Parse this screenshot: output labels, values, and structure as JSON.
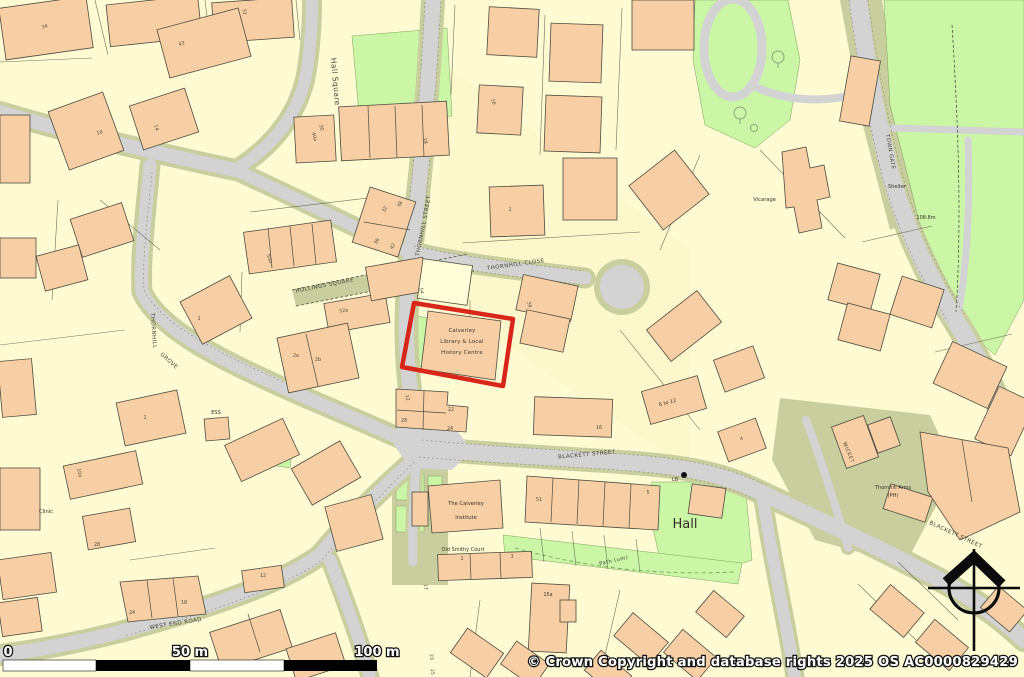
{
  "map": {
    "title": "OS street map extract - Calverley",
    "highlight": {
      "name": "Calverley Library and Local History Centre",
      "line1": "Calverley",
      "line2": "Library & Local",
      "line3": "History Centre",
      "outline_color": "#d9261a"
    },
    "hall_label": "Hall",
    "streets": [
      {
        "t": "Hall Square",
        "x": 333,
        "y": 82,
        "r": 85,
        "s": 7.5
      },
      {
        "t": "THORNHILL STREET",
        "x": 425,
        "y": 226,
        "r": -79,
        "s": 5.5
      },
      {
        "t": "THORNHILL CLOSE",
        "x": 516,
        "y": 266,
        "r": -8,
        "s": 5.5
      },
      {
        "t": "HOLLINGS SQUARE",
        "x": 325,
        "y": 287,
        "r": -11,
        "s": 5.5
      },
      {
        "t": "THORNHILL",
        "x": 152,
        "y": 331,
        "r": 86,
        "s": 5.5
      },
      {
        "t": "GROVE",
        "x": 168,
        "y": 362,
        "r": 42,
        "s": 5.5
      },
      {
        "t": "BLACKETT STREET",
        "x": 587,
        "y": 456,
        "r": -5,
        "s": 5.5
      },
      {
        "t": "BLACKETT STREET",
        "x": 955,
        "y": 536,
        "r": 25,
        "s": 5.5
      },
      {
        "t": "WEST END ROAD",
        "x": 176,
        "y": 625,
        "r": -9,
        "s": 5.5
      },
      {
        "t": "TOWN GATE",
        "x": 889,
        "y": 152,
        "r": 80,
        "s": 5.2
      },
      {
        "t": "WICKET",
        "x": 847,
        "y": 453,
        "r": 68,
        "s": 5
      },
      {
        "t": "Path (um)",
        "x": 614,
        "y": 562,
        "r": -13,
        "s": 5.2
      }
    ],
    "places": [
      {
        "t": "Vicarage",
        "x": 776,
        "y": 201,
        "s": 5.2,
        "a": "end"
      },
      {
        "t": "Shelter",
        "x": 897,
        "y": 188,
        "s": 5
      },
      {
        "t": "108.8m",
        "x": 926,
        "y": 219,
        "s": 5
      },
      {
        "t": "The Calverley",
        "x": 466,
        "y": 505,
        "s": 5.2
      },
      {
        "t": "Institute",
        "x": 466,
        "y": 519,
        "s": 5.2
      },
      {
        "t": "Old Smithy Court",
        "x": 463,
        "y": 551,
        "s": 5
      },
      {
        "t": "Thornhill Arms",
        "x": 893,
        "y": 489,
        "s": 5
      },
      {
        "t": "(PH)",
        "x": 893,
        "y": 497,
        "s": 5
      },
      {
        "t": "Clinic",
        "x": 46,
        "y": 513,
        "s": 5.2
      },
      {
        "t": "ESS",
        "x": 216,
        "y": 414,
        "s": 5
      },
      {
        "t": "LB",
        "x": 675,
        "y": 481,
        "s": 4.8
      },
      {
        "t": "6 to 12",
        "x": 668,
        "y": 404,
        "r": -15,
        "s": 5
      },
      {
        "t": "15a",
        "x": 548,
        "y": 596,
        "s": 4.8
      }
    ],
    "house_numbers": [
      {
        "t": "34",
        "x": 45,
        "y": 28,
        "r": -15
      },
      {
        "t": "31",
        "x": 243,
        "y": 12,
        "r": 80
      },
      {
        "t": "43",
        "x": 182,
        "y": 45,
        "r": -18
      },
      {
        "t": "19",
        "x": 100,
        "y": 134,
        "r": -15
      },
      {
        "t": "14",
        "x": 155,
        "y": 128,
        "r": 75
      },
      {
        "t": "18",
        "x": 424,
        "y": 141,
        "r": 80
      },
      {
        "t": "30",
        "x": 320,
        "y": 128,
        "r": 75
      },
      {
        "t": "40a",
        "x": 313,
        "y": 137,
        "r": 75
      },
      {
        "t": "16",
        "x": 492,
        "y": 102,
        "r": 75
      },
      {
        "t": "32",
        "x": 386,
        "y": 210,
        "r": -60
      },
      {
        "t": "38",
        "x": 401,
        "y": 205,
        "r": -60
      },
      {
        "t": "36",
        "x": 378,
        "y": 242,
        "r": -60
      },
      {
        "t": "42",
        "x": 394,
        "y": 247,
        "r": -60
      },
      {
        "t": "50a",
        "x": 268,
        "y": 259,
        "r": 70
      },
      {
        "t": "52a",
        "x": 344,
        "y": 312,
        "r": -10
      },
      {
        "t": "2a",
        "x": 296,
        "y": 357,
        "r": 0
      },
      {
        "t": "2b",
        "x": 318,
        "y": 361,
        "r": 0
      },
      {
        "t": "1",
        "x": 199,
        "y": 320,
        "r": 0
      },
      {
        "t": "1",
        "x": 510,
        "y": 211,
        "r": 0
      },
      {
        "t": "54",
        "x": 420,
        "y": 291,
        "r": 80
      },
      {
        "t": "34",
        "x": 528,
        "y": 305,
        "r": 70
      },
      {
        "t": "12",
        "x": 406,
        "y": 398,
        "r": 80
      },
      {
        "t": "22",
        "x": 451,
        "y": 411,
        "r": 0
      },
      {
        "t": "28",
        "x": 404,
        "y": 422,
        "r": 0
      },
      {
        "t": "24",
        "x": 450,
        "y": 430,
        "r": 0
      },
      {
        "t": "16",
        "x": 599,
        "y": 429,
        "r": 0
      },
      {
        "t": "51",
        "x": 539,
        "y": 501,
        "r": 0
      },
      {
        "t": "5",
        "x": 648,
        "y": 494,
        "r": 0
      },
      {
        "t": "1",
        "x": 462,
        "y": 560,
        "r": 0
      },
      {
        "t": "3",
        "x": 512,
        "y": 558,
        "r": 0
      },
      {
        "t": "17",
        "x": 424,
        "y": 587,
        "r": 85
      },
      {
        "t": "23",
        "x": 430,
        "y": 657,
        "r": 85
      },
      {
        "t": "25",
        "x": 431,
        "y": 672,
        "r": 85
      },
      {
        "t": "24",
        "x": 132,
        "y": 614,
        "r": 0
      },
      {
        "t": "18",
        "x": 184,
        "y": 604,
        "r": 0
      },
      {
        "t": "12",
        "x": 263,
        "y": 577,
        "r": 0
      },
      {
        "t": "10a",
        "x": 78,
        "y": 473,
        "r": 78
      },
      {
        "t": "28",
        "x": 97,
        "y": 546,
        "r": 0
      },
      {
        "t": "1",
        "x": 145,
        "y": 419,
        "r": 0
      },
      {
        "t": "4",
        "x": 742,
        "y": 440,
        "r": -20
      }
    ]
  },
  "scale_bar": {
    "labels": {
      "start": "0",
      "middle": "50 m",
      "end": "100 m"
    }
  },
  "attribution": "© Crown Copyright and database rights 2025 OS AC0000829429",
  "colors": {
    "parcel_cream": "#FEFBD3",
    "building_peach": "#F8CFA4",
    "road_gray": "#D3D3D3",
    "verge_khaki": "#C9CE9E",
    "green_space": "#CBF6A6",
    "highlight_red": "#d9261a"
  }
}
